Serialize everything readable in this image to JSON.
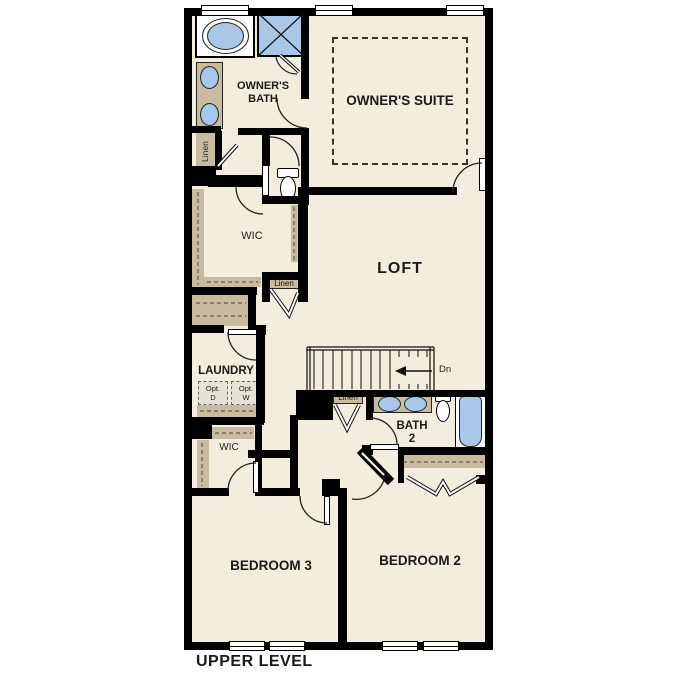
{
  "plan_title": "UPPER LEVEL",
  "rooms": {
    "owners_suite": "OWNER'S SUITE",
    "owners_bath": "OWNER'S BATH",
    "loft": "LOFT",
    "laundry": "LAUNDRY",
    "bath2_line1": "BATH",
    "bath2_line2": "2",
    "bedroom2": "BEDROOM 2",
    "bedroom3": "BEDROOM 3",
    "wic_owners": "WIC",
    "wic_bedroom3": "WIC"
  },
  "closets": {
    "linen_bath": "Linen",
    "linen_hall": "Linen",
    "linen_stairs": "Linen"
  },
  "stairs": {
    "down_label": "Dn"
  },
  "laundry_options": {
    "dryer_line1": "Opt.",
    "dryer_line2": "D",
    "washer_line1": "Opt.",
    "washer_line2": "W"
  },
  "colors": {
    "floor": "#f3edde",
    "wall": "#000000",
    "cabinet_tan": "#c9bc9e",
    "fixture_blue": "#a9c7e8",
    "option_grey": "#e7e2d6"
  }
}
